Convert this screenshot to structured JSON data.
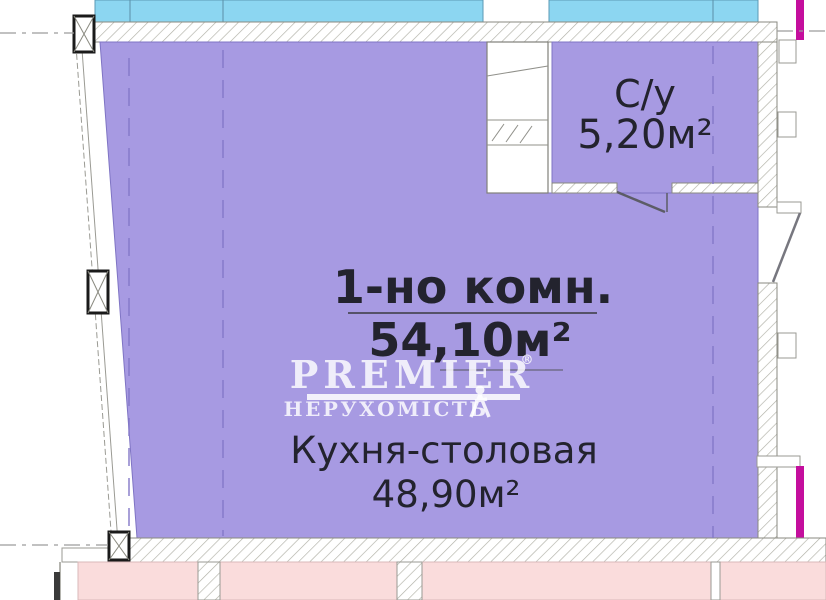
{
  "apartment": {
    "type_label": "1-но комн.",
    "total_area": "54,10м²",
    "rooms": [
      {
        "label": "Кухня-столовая",
        "area": "48,90м²"
      },
      {
        "label": "С/у",
        "area": "5,20м²"
      }
    ]
  },
  "watermark": {
    "brand": "PREMIER",
    "registered": "®",
    "subtitle": "НЕРУХОМІСТЬ"
  },
  "colors": {
    "room_fill": "#a79ae2",
    "room_stroke": "#7f74c4",
    "balcony_fill": "#8cd6f1",
    "neighbor_fill": "#fadcdc",
    "accent_magenta": "#c40e9d",
    "grid_dash": "#8478c8",
    "text": "#23232e",
    "watermark": "#ffffff"
  }
}
